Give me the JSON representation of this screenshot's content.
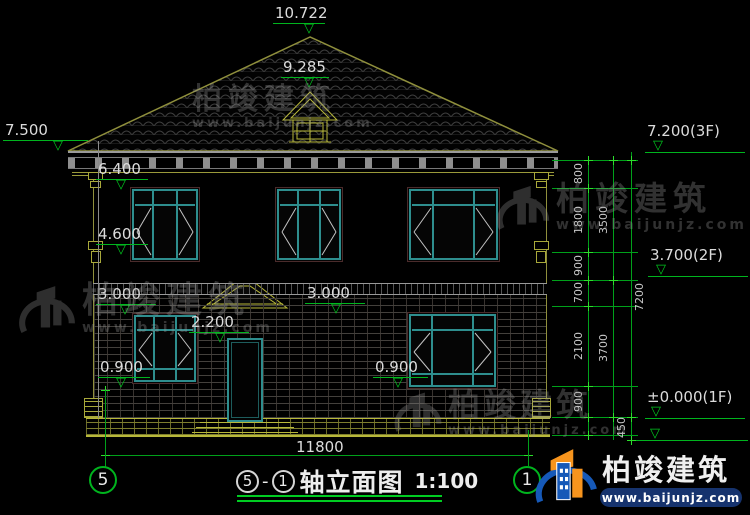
{
  "drawing": {
    "title": {
      "axis_left": "5",
      "sep": "-",
      "axis_right": "1",
      "name": "轴立面图",
      "scale": "1:100"
    },
    "levels": {
      "peak": "10.722",
      "vent": "9.285",
      "eave": "7.500",
      "cornice_top": "6.400",
      "sill_2f": "4.600",
      "floor_2f_left": "3.000",
      "floor_2f_mid": "3.000",
      "door_head": "2.200",
      "sill_1f_left": "0.900",
      "sill_1f_right": "0.900",
      "f3": "7.200(3F)",
      "f2": "3.700(2F)",
      "f1": "±0.000(1F)"
    },
    "dims": {
      "width_total": "11800",
      "chain": [
        "800",
        "1800",
        "900",
        "700",
        "2100",
        "900",
        "450"
      ],
      "chain_mid": [
        "3500",
        "3700"
      ],
      "chain_total": "7200"
    },
    "axes": {
      "left": "5",
      "right": "1"
    }
  },
  "watermark": {
    "name": "柏竣建筑",
    "url": "www.baijunjz.com"
  },
  "brand": {
    "name": "柏竣建筑",
    "url": "www.baijunjz.com"
  },
  "colors": {
    "dimension_green": "#00b41e",
    "line_yellow": "#b8b83a",
    "roof_olive": "#8f8f3c",
    "window_teal": "#2e8e8e",
    "brand_blue": "#1659b8",
    "brand_orange": "#f7941d"
  }
}
